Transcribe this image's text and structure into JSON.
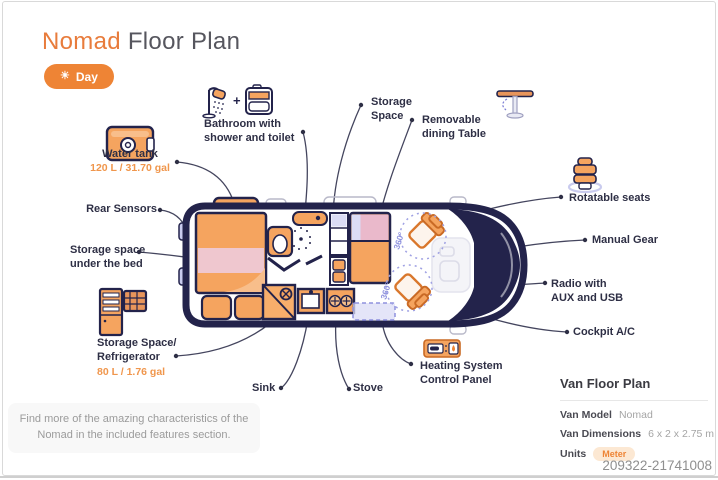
{
  "header": {
    "title_accent": "Nomad",
    "title_rest": " Floor Plan",
    "mode_toggle": {
      "icon": "sun-icon",
      "label": "Day"
    }
  },
  "annotations": {
    "water_tank": {
      "label": "Water tank",
      "value": "120 L / 31.70 gal"
    },
    "rear_sensors": {
      "label": "Rear Sensors"
    },
    "under_bed": {
      "lines": [
        "Storage space",
        "under the bed"
      ]
    },
    "fridge": {
      "lines": [
        "Storage Space/",
        "Refrigerator"
      ],
      "value": "80 L / 1.76 gal"
    },
    "sink": {
      "label": "Sink"
    },
    "stove": {
      "label": "Stove"
    },
    "bathroom": {
      "lines": [
        "Bathroom with",
        "shower and toilet"
      ]
    },
    "storage_space": {
      "lines": [
        "Storage",
        "Space"
      ]
    },
    "dining_table": {
      "lines": [
        "Removable",
        "dining Table"
      ]
    },
    "rotatable_seats": {
      "label": "Rotatable seats"
    },
    "manual_gear": {
      "label": "Manual Gear"
    },
    "radio": {
      "lines": [
        "Radio with",
        "AUX and USB"
      ]
    },
    "cockpit": {
      "label": "Cockpit A/C"
    },
    "heating": {
      "lines": [
        "Heating System",
        "Control Panel"
      ]
    }
  },
  "van": {
    "rotation_badge": "360°"
  },
  "note": {
    "text": "Find more of the amazing characteristics of the Nomad in the included features section."
  },
  "info_panel": {
    "title": "Van Floor Plan",
    "rows": [
      {
        "label": "Van Model",
        "value": "Nomad"
      },
      {
        "label": "Van Dimensions",
        "value": "6 x 2 x 2.75 m"
      },
      {
        "label": "Units",
        "value": "Meter"
      }
    ]
  },
  "footer": {
    "id": "209322-21741008"
  },
  "colors": {
    "accent": "#ee8435",
    "furniture_orange": "#f5a45f",
    "navy": "#23234b",
    "lavender": "#dbdcf5",
    "purple": "#8f92de",
    "pink": "#efc7cf"
  }
}
